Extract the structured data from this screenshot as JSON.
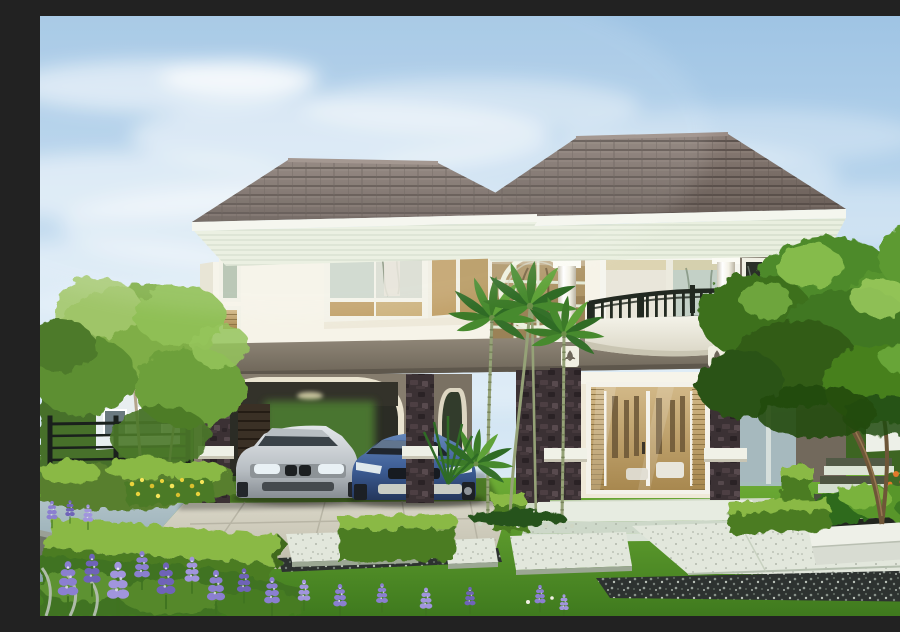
{
  "scene": {
    "title": "Modern two-storey tropical house with carport and landscaped garden",
    "description": "Daytime architectural rendering of a white two-storey house with dark grey hipped tile roofs, a curved first-floor balcony with dark metal railing, a double-height glazed atrium with a circular ring motif, an arched double carport sheltering a silver sedan and a blue sports car, stone-clad pillars, slender palm trees, clipped box hedges, purple lupine flowers, yellow and orange flower beds, stone stepping pads, a white planter bench and a manicured lawn under a lightly clouded blue sky.",
    "time_of_day": "day",
    "weather": "sunny with light clouds",
    "house": {
      "storeys": 2,
      "wall_finish": "white render",
      "roof": "dark grey concrete tiles, hipped, two levels",
      "features": [
        "curved balcony with dark metal railing",
        "double-height glazed atrium with circular ring motif",
        "white round columns",
        "dark stone-clad pillars with white accent blocks",
        "arched double carport",
        "white sliding glass entrance door with warm interior light",
        "tulip relief emblems on the grey fascia band",
        "slatted white soffits"
      ]
    },
    "vehicles": [
      {
        "name": "silver sedan",
        "body_color": "#c6cacd"
      },
      {
        "name": "blue sports car",
        "body_color": "#3c5c94"
      }
    ],
    "landscape": {
      "foreground": [
        "lawn",
        "concrete driveway",
        "blue-grey walkway",
        "stepping stone pads",
        "dark gravel borders",
        "white stone planter bench",
        "garden steps"
      ],
      "plants": [
        "palm trees",
        "large shade trees",
        "clipped box hedges",
        "purple lupine flowers",
        "yellow flower bed",
        "orange flowers",
        "strappy planter foliage",
        "silver foliage"
      ],
      "boundary": [
        "black metal fence",
        "neighbouring houses left and right"
      ]
    },
    "palette": {
      "sky_top": "#9fc4e4",
      "sky_mid": "#c3dcf0",
      "sky_low": "#dcebf5",
      "cloud": "#ffffff",
      "roof_dark": "#5f544f",
      "roof_mid": "#7b6e68",
      "roof_light": "#9a8c85",
      "fascia": "#f4f6ee",
      "soffit": "#e9efdf",
      "wall": "#f6f3e8",
      "wall_shade": "#e6e2d2",
      "accent_gray": "#7d7468",
      "band_gray": "#8a8172",
      "stone": "#3b3134",
      "stone_light": "#5a4c50",
      "glass_cool": "#c8d4c9",
      "glass_warm": "#c5a979",
      "interior_amber": "#a8884f",
      "railing": "#222921",
      "column": "#fbfbf4",
      "drive": "#d5d2c2",
      "walk_blue": "#a3b8c0",
      "slab": "#e2e7dc",
      "gravel": "#2e3331",
      "porch": "#e7ece1",
      "lawn_light": "#7cb43d",
      "lawn_dark": "#47801f",
      "hedge_light": "#8ab944",
      "hedge_dark": "#4c7c24",
      "leaf_light": "#9ac95e",
      "leaf_mid": "#5d9430",
      "leaf_dark": "#2f571c",
      "palm_green": "#3e7d27",
      "trunk_pale": "#95a277",
      "tree_trunk": "#6e5638",
      "flower_purple": "#8b7fd0",
      "flower_purple_dark": "#6f63b8",
      "flower_yellow": "#ead23c",
      "flower_orange": "#e2792b"
    }
  }
}
